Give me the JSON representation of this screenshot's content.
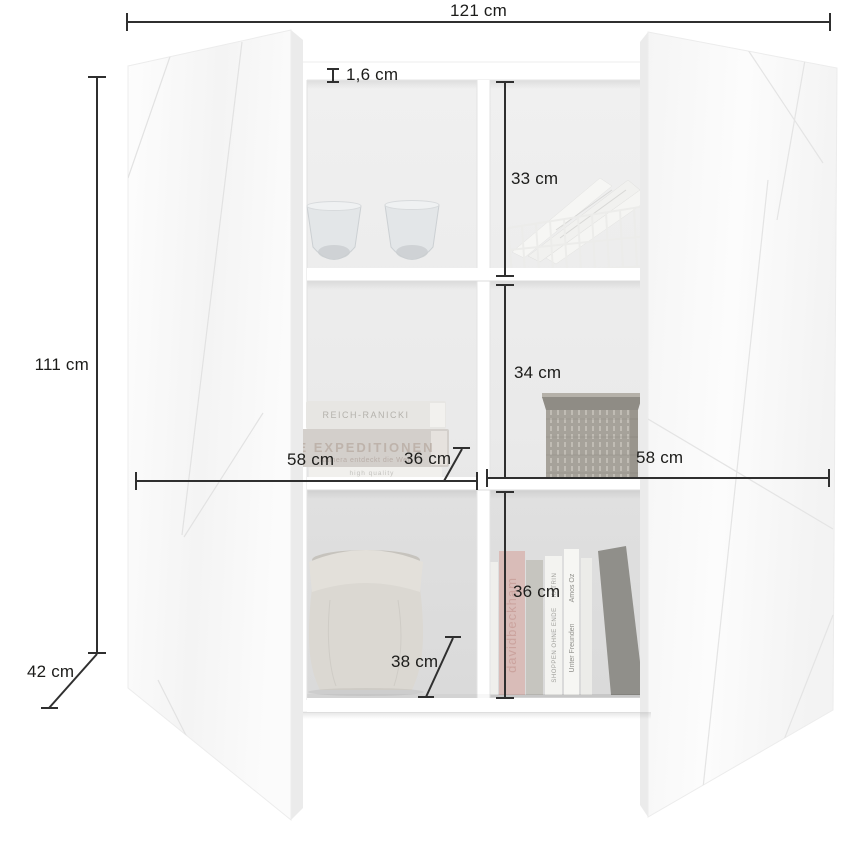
{
  "figure": {
    "description": "Dimension diagram of a white two-door highboard with six open compartments",
    "unit": "cm"
  },
  "dims": {
    "total_width": "121 cm",
    "total_height": "111 cm",
    "total_depth": "42 cm",
    "panel_thickness": "1,6 cm",
    "compartment_top": "33 cm",
    "compartment_middle": "34 cm",
    "compartment_bottom": "36 cm",
    "section_left_width": "58 cm",
    "section_right_width": "58 cm",
    "shelf_depth_middle": "36 cm",
    "shelf_depth_bottom": "38 cm"
  },
  "decor": {
    "book_stack": {
      "top": "REICH-RANICKI",
      "middle_title": "E EXPEDITIONEN",
      "middle_subtitle": "Kamera entdeckt die Welt",
      "bottom": "high quality"
    },
    "book_row": {
      "beckham": "davidbeckham",
      "katrin_author": "KATRIN",
      "katrin_title": "SHOPPEN OHNE ENDE",
      "amos_author": "Amos Oz",
      "amos_title": "Unter Freunden"
    }
  },
  "colors": {
    "dimension_line": "#2f2f2f",
    "label_text": "#1c1c1a",
    "door_white": "#fafafa",
    "interior_back": "#ebebeb",
    "shelf_white": "#ffffff"
  }
}
